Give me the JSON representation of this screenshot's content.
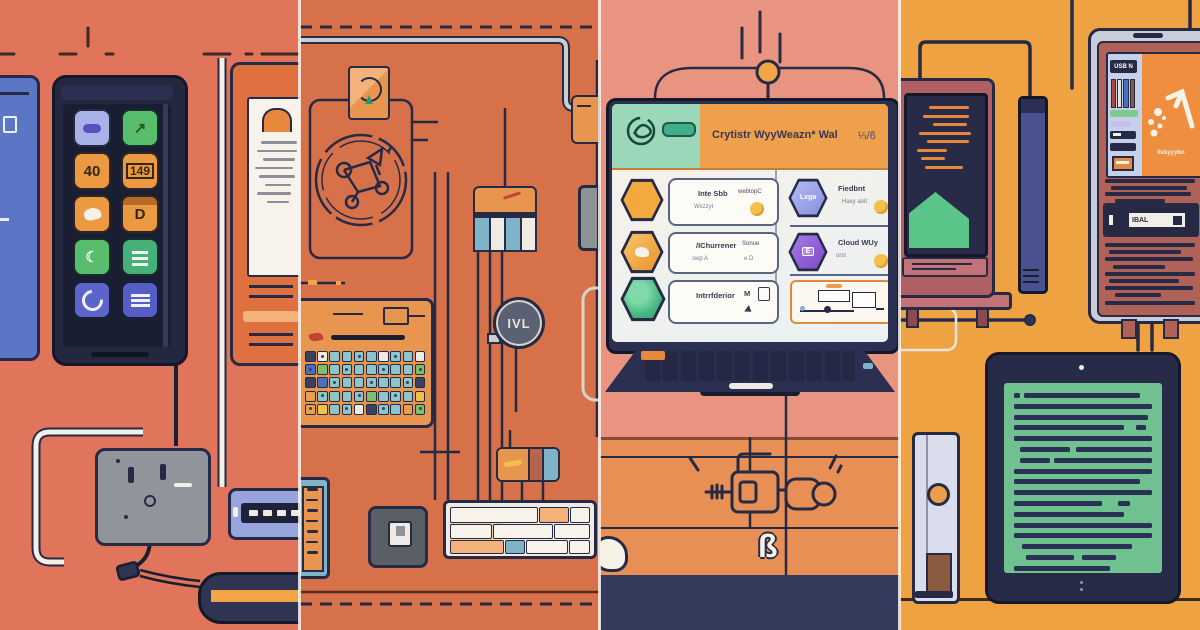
{
  "palette": {
    "ink": "#262A45",
    "panel1_bg": "#E0755C",
    "panel2_bg": "#D6714A",
    "panel3_bg": "#E99480",
    "panel3_desk": "#E78F55",
    "panel4_bg": "#EFA242",
    "accent_orange": "#F2A544",
    "accent_green": "#47B881",
    "accent_teal": "#7FB3C8",
    "accent_periwinkle": "#97A0E8",
    "accent_purple": "#8F5FD8",
    "accent_yellow": "#F2C14B"
  },
  "panel1": {
    "phone_icons": [
      {
        "name": "cassette-app-icon",
        "bg": "#A9B3E9",
        "shape": "pill",
        "glyph": ""
      },
      {
        "name": "route-app-icon",
        "bg": "#58BD6C",
        "glyph": "↗",
        "fg": "#1E5A33"
      },
      {
        "name": "gauge-40-app-icon",
        "bg": "#EC9A41",
        "glyph": "40",
        "fg": "#33270F"
      },
      {
        "name": "number-149-app-icon",
        "bg": "#EC9A41",
        "glyph": "149",
        "fg": "#33270F",
        "shape": "boxed"
      },
      {
        "name": "dove-app-icon",
        "bg": "#EC9A41",
        "shape": "bird",
        "glyph": ""
      },
      {
        "name": "d-app-icon",
        "bg": "#EC9A41",
        "glyph": "D",
        "fg": "#33270F",
        "shape": "topbar"
      },
      {
        "name": "moon-app-icon",
        "bg": "#58BD6C",
        "glyph": "☾",
        "fg": "#F2F7EF"
      },
      {
        "name": "memo-app-icon",
        "bg": "#45B077",
        "shape": "bars",
        "glyph": ""
      },
      {
        "name": "swirl-app-icon",
        "bg": "#5A64C9",
        "shape": "swirl",
        "glyph": ""
      },
      {
        "name": "list-app-icon",
        "bg": "#545EC4",
        "shape": "list",
        "glyph": ""
      }
    ]
  },
  "panel2": {
    "module_label": "IVL"
  },
  "panel3": {
    "laptop": {
      "title": "Crytistr WyyWeazn* Wal",
      "meta": "⅓/ϐ",
      "cards": [
        {
          "hex": "#F2AA3E",
          "title": "Inte Sbb",
          "sub": "Wxzzyt",
          "right": "webtopC"
        },
        {
          "hex": "#97A0E8",
          "hex_label": "Lxga",
          "title": "Fiedbnt",
          "sub": "Haxy aoit"
        },
        {
          "hex": "#F4B03C",
          "title": "/IChurrener",
          "sub": "swp A",
          "right": "Sonue",
          "right_sub": "e  D"
        },
        {
          "hex": "#8F5FD8",
          "hex_label": "E",
          "title": "Cloud WUy",
          "sub": "orst"
        },
        {
          "hex": "#47B881",
          "title": "Intrrfderior",
          "right": "M"
        }
      ]
    },
    "desk_glyph": "ß"
  },
  "panel4": {
    "tablet": {
      "badge": "USB N",
      "logo_text": "Ilxkyyybo",
      "drive_label": "IBAL"
    }
  }
}
